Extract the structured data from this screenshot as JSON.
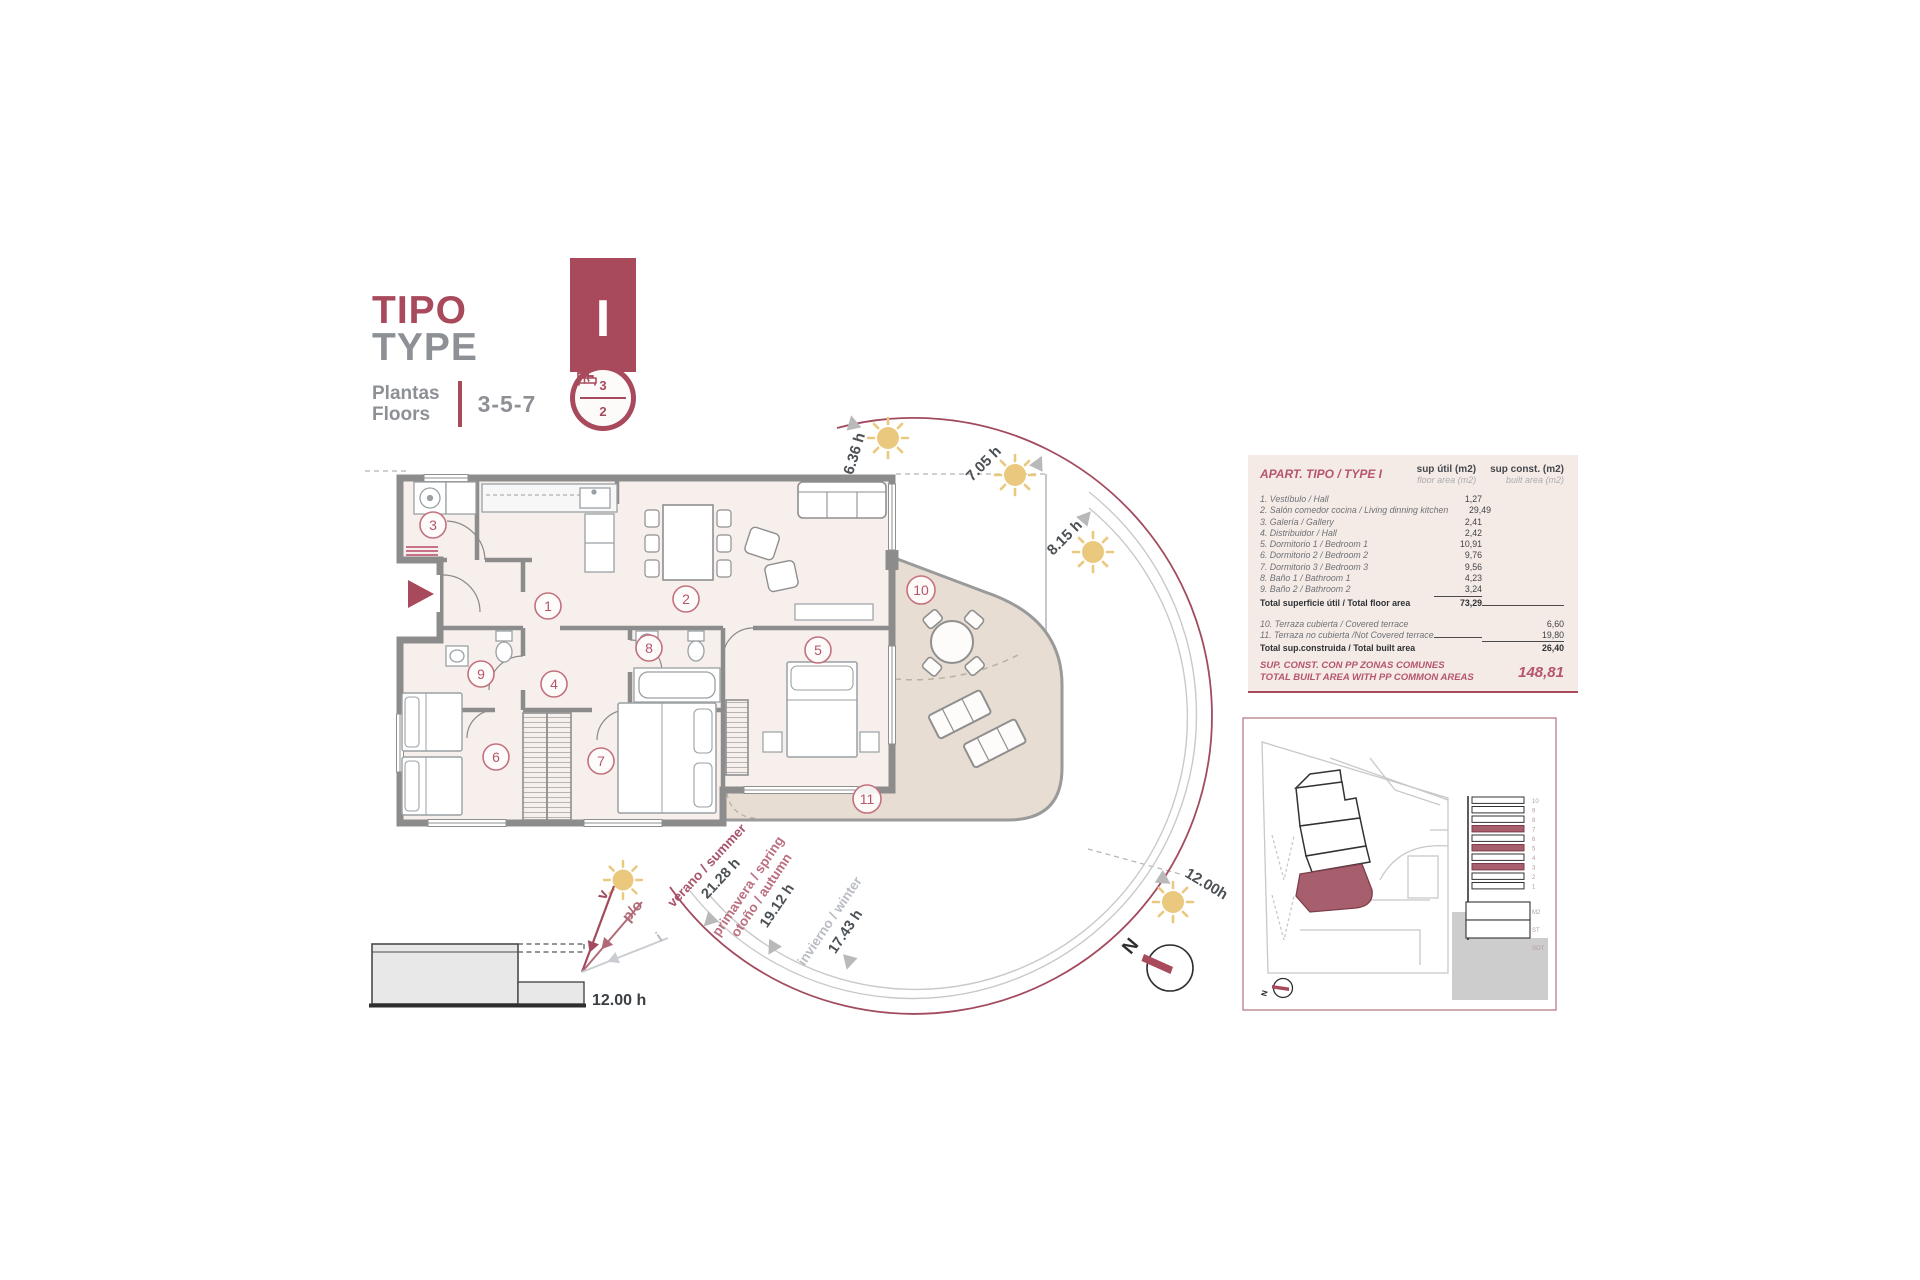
{
  "title_block": {
    "title_primary": "TIPO",
    "title_secondary": "TYPE",
    "floors_label_line1": "Plantas",
    "floors_label_line2": "Floors",
    "floors_value": "3-5-7",
    "type_letter": "I",
    "bedrooms_count": "3",
    "bathrooms_count": "2"
  },
  "area_table": {
    "title": "APART. TIPO / TYPE I",
    "col_floor_line1": "sup útil (m2)",
    "col_floor_line2": "floor area (m2)",
    "col_built_line1": "sup const. (m2)",
    "col_built_line2": "built area (m2)",
    "rows": [
      {
        "label": "1. Vestíbulo / Hall",
        "floor": "1,27",
        "built": ""
      },
      {
        "label": "2. Salón comedor cocina / Living dinning kitchen",
        "floor": "29,49",
        "built": ""
      },
      {
        "label": "3. Galería / Gallery",
        "floor": "2,41",
        "built": ""
      },
      {
        "label": "4. Distribuidor / Hall",
        "floor": "2,42",
        "built": ""
      },
      {
        "label": "5. Dormitorio 1 / Bedroom 1",
        "floor": "10,91",
        "built": ""
      },
      {
        "label": "6. Dormitorio 2 / Bedroom 2",
        "floor": "9,76",
        "built": ""
      },
      {
        "label": "7. Dormitorio 3 / Bedroom 3",
        "floor": "9,56",
        "built": ""
      },
      {
        "label": "8. Baño 1 / Bathroom 1",
        "floor": "4,23",
        "built": ""
      },
      {
        "label": "9. Baño 2 / Bathroom 2",
        "floor": "3,24",
        "built": ""
      }
    ],
    "total_floor": {
      "label": "Total superficie útil / Total floor area",
      "value": "73,29"
    },
    "terrace_rows": [
      {
        "label": "10. Terraza cubierta / Covered terrace",
        "built": "6,60"
      },
      {
        "label": "11. Terraza no cubierta /Not Covered terrace",
        "built": "19,80"
      }
    ],
    "total_built": {
      "label": "Total sup.construida / Total built area",
      "value": "26,40"
    },
    "footer": {
      "line1": "SUP. CONST. CON PP ZONAS COMUNES",
      "line2": "TOTAL BUILT AREA WITH PP COMMON AREAS",
      "value": "148,81"
    }
  },
  "floor_plan": {
    "room_numbers": [
      "1",
      "2",
      "3",
      "4",
      "5",
      "6",
      "7",
      "8",
      "9",
      "10",
      "11"
    ]
  },
  "sun_diagram": {
    "hour_labels": {
      "sunrise": "6.36 h",
      "early": "7.05 h",
      "mid": "8.15 h",
      "noon": "12.00h"
    },
    "seasons": {
      "summer": {
        "label": "verano / summer",
        "hours": "21.28 h"
      },
      "spring_autumn": {
        "label_line1": "primavera / spring",
        "label_line2": "otoño / autumn",
        "hours": "19.12 h"
      },
      "winter": {
        "label": "invierno / winter",
        "hours": "17.43 h"
      }
    },
    "compass_n": "N"
  },
  "section_diagram": {
    "sun_v": "v",
    "sun_po": "p/o",
    "sun_i": "i",
    "noon_label": "12.00 h"
  },
  "site_panel": {
    "floor_labels": [
      "10",
      "9",
      "8",
      "7",
      "6",
      "5",
      "4",
      "3",
      "2",
      "1",
      "M2",
      "ST",
      "SOT"
    ],
    "compass_n": "N"
  },
  "colors": {
    "brand": "#a8495c",
    "brand_light": "#bb6375",
    "gray_text": "#8d9196",
    "dark_text": "#4a4e53",
    "wall_gray": "#8c8c8c",
    "room_fill": "#f6efeb",
    "terrace_fill": "#e7ddd2",
    "table_bg": "#f4eae6",
    "sun_yellow": "#eac87e",
    "marker_gray": "#b9b9b9"
  }
}
